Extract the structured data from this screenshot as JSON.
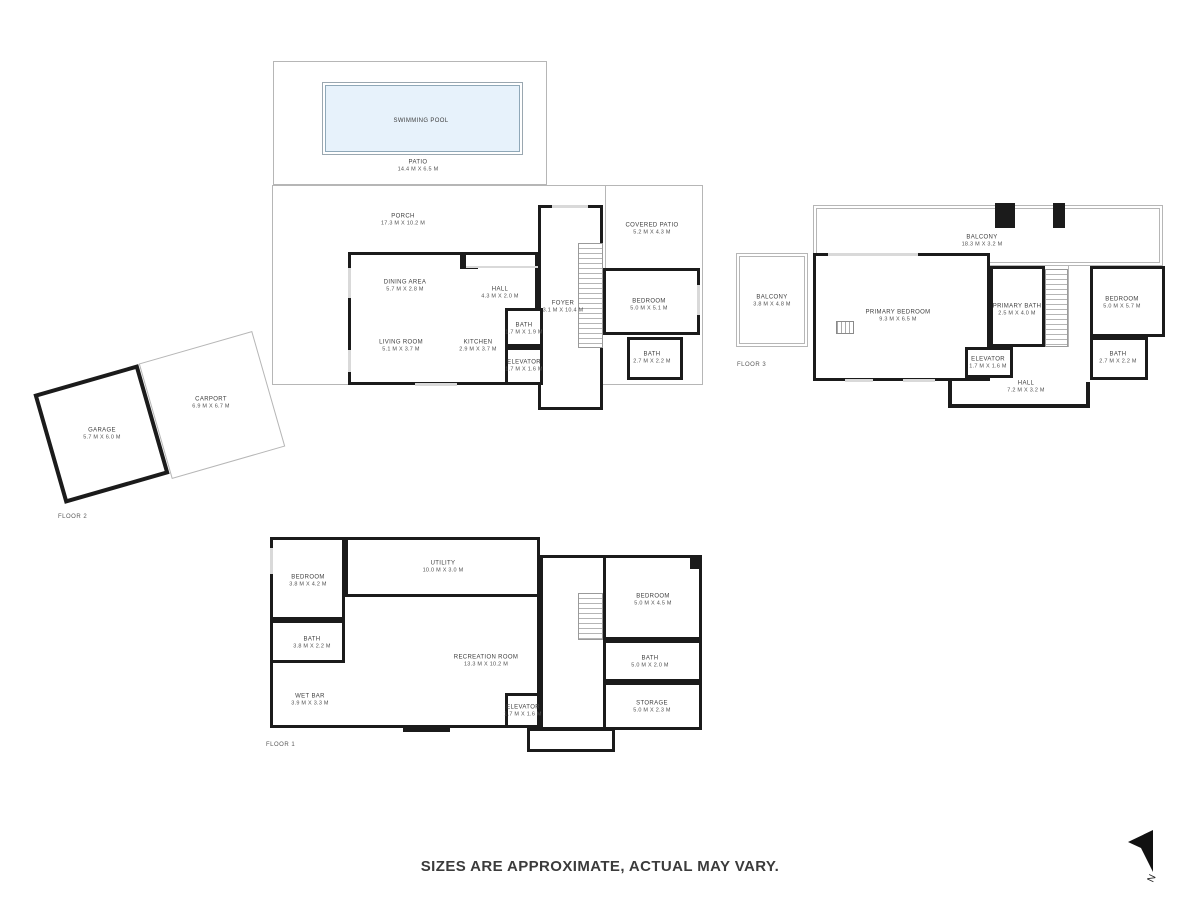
{
  "footer": {
    "disclaimer": "SIZES ARE APPROXIMATE, ACTUAL MAY VARY."
  },
  "compass": {
    "north_label": "N"
  },
  "colors": {
    "wall": "#1b1b1b",
    "outline": "#b6b6b6",
    "pool_fill": "#e7f2fb",
    "label_text": "#3e3e3e"
  },
  "floors": [
    {
      "label": "FLOOR 2",
      "rooms": [
        {
          "name": "SWIMMING POOL",
          "dims": ""
        },
        {
          "name": "PATIO",
          "dims": "14.4 M X 6.5 M"
        },
        {
          "name": "PORCH",
          "dims": "17.3 M X 10.2 M"
        },
        {
          "name": "COVERED PATIO",
          "dims": "5.2 M X 4.3 M"
        },
        {
          "name": "DINING AREA",
          "dims": "5.7 M X 2.8 M"
        },
        {
          "name": "HALL",
          "dims": "4.3 M X 2.0 M"
        },
        {
          "name": "LIVING ROOM",
          "dims": "5.1 M X 3.7 M"
        },
        {
          "name": "KITCHEN",
          "dims": "2.9 M X 3.7 M"
        },
        {
          "name": "BATH",
          "dims": "1.7 M X 1.9 M"
        },
        {
          "name": "ELEVATOR",
          "dims": "1.7 M X 1.6 M"
        },
        {
          "name": "FOYER",
          "dims": "3.1 M X 10.4 M"
        },
        {
          "name": "BEDROOM",
          "dims": "5.0 M X 5.1 M"
        },
        {
          "name": "BATH",
          "dims": "2.7 M X 2.2 M"
        },
        {
          "name": "GARAGE",
          "dims": "5.7 M X 6.0 M"
        },
        {
          "name": "CARPORT",
          "dims": "6.9 M X 6.7 M"
        }
      ]
    },
    {
      "label": "FLOOR 3",
      "rooms": [
        {
          "name": "BALCONY",
          "dims": "3.8 M X 4.8 M"
        },
        {
          "name": "BALCONY",
          "dims": "18.3 M X 3.2 M"
        },
        {
          "name": "PRIMARY BEDROOM",
          "dims": "9.3 M X 6.5 M"
        },
        {
          "name": "PRIMARY BATH",
          "dims": "2.5 M X 4.0 M"
        },
        {
          "name": "ELEVATOR",
          "dims": "1.7 M X 1.6 M"
        },
        {
          "name": "HALL",
          "dims": "7.2 M X 3.2 M"
        },
        {
          "name": "BEDROOM",
          "dims": "5.0 M X 5.7 M"
        },
        {
          "name": "BATH",
          "dims": "2.7 M X 2.2 M"
        }
      ]
    },
    {
      "label": "FLOOR 1",
      "rooms": [
        {
          "name": "BEDROOM",
          "dims": "3.8 M X 4.2 M"
        },
        {
          "name": "UTILITY",
          "dims": "10.0 M X 3.0 M"
        },
        {
          "name": "BATH",
          "dims": "3.8 M X 2.2 M"
        },
        {
          "name": "WET BAR",
          "dims": "3.9 M X 3.3 M"
        },
        {
          "name": "RECREATION ROOM",
          "dims": "13.3 M X 10.2 M"
        },
        {
          "name": "ELEVATOR",
          "dims": "1.7 M X 1.6 M"
        },
        {
          "name": "BEDROOM",
          "dims": "5.0 M X 4.5 M"
        },
        {
          "name": "BATH",
          "dims": "5.0 M X 2.0 M"
        },
        {
          "name": "STORAGE",
          "dims": "5.0 M X 2.3 M"
        }
      ]
    }
  ]
}
